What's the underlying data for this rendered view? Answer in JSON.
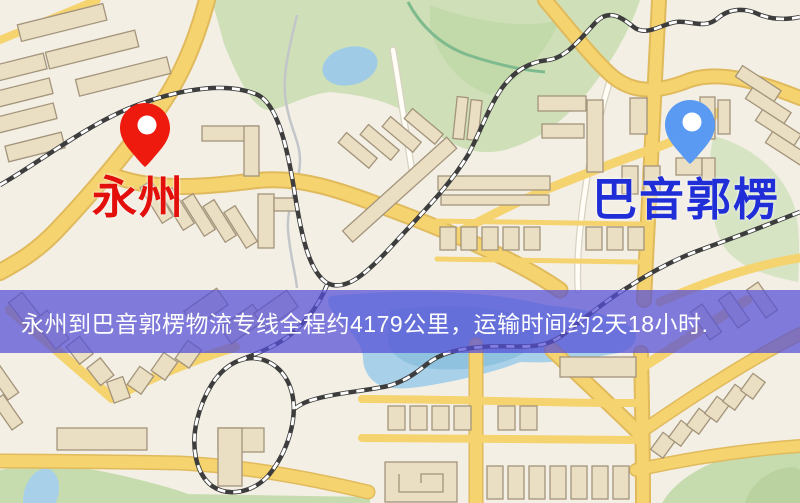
{
  "map": {
    "origin": {
      "label": "永州",
      "label_color": "#e30f0a",
      "pin_color": "#ef1a0e",
      "pin_icon": "map-pin"
    },
    "destination": {
      "label": "巴音郭楞",
      "label_color": "#1f2ed6",
      "pin_color": "#5b9af2",
      "pin_icon": "map-pin"
    },
    "banner": {
      "text": "永州到巴音郭楞物流专线全程约4179公里，运输时间约2天18小时.",
      "background": "rgba(85,80,215,0.73)",
      "text_color": "#ffffff"
    }
  }
}
